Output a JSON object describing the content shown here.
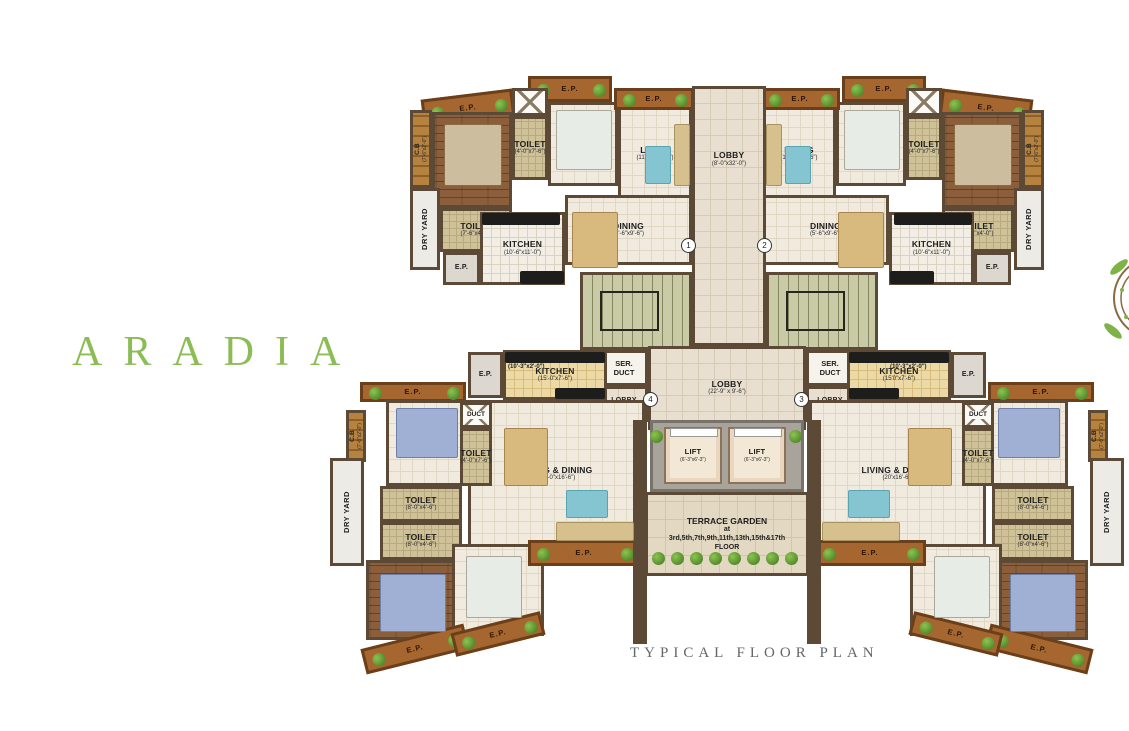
{
  "title": {
    "text": "ARADIA"
  },
  "caption": {
    "text": "TYPICAL FLOOR PLAN"
  },
  "colors": {
    "accent_green": "#8cbd55",
    "wall_brown": "#5c4a37",
    "caption_gray": "#63666b",
    "balcony_brown": "#a5672f"
  },
  "rooms": [
    {
      "id": "ep-balcony-tl-outer",
      "type": "ep",
      "name": "E.P.",
      "x": 528,
      "y": 76,
      "w": 84,
      "h": 26
    },
    {
      "id": "ep-balcony-tl-corner",
      "type": "ep",
      "name": "E.P.",
      "x": 422,
      "y": 94,
      "w": 92,
      "h": 28,
      "rot": -7
    },
    {
      "id": "cupboard-tl",
      "type": "cb",
      "vert": true,
      "name": "C.B",
      "dims": "(7'-6\"x2'-0\")",
      "x": 410,
      "y": 110,
      "w": 22,
      "h": 78
    },
    {
      "id": "bedroom2-tl",
      "type": "wood",
      "name": "BED 2",
      "dims": "(10'-0\"x12'-0\")",
      "x": 432,
      "y": 112,
      "w": 80,
      "h": 96
    },
    {
      "id": "duct-shaft-tl",
      "type": "ductx",
      "x": 512,
      "y": 88,
      "w": 36,
      "h": 28
    },
    {
      "id": "toilet1-tl",
      "type": "toilet",
      "name": "TOILET",
      "dims": "(4'-0\"x7'-6\")",
      "x": 512,
      "y": 116,
      "w": 36,
      "h": 64
    },
    {
      "id": "bedroom1-tl",
      "type": "cream",
      "name": "BED 1",
      "dims": "(9'-0\"x11'-0\")",
      "x": 548,
      "y": 102,
      "w": 70,
      "h": 84
    },
    {
      "id": "dryyard-tl",
      "type": "dry",
      "vert": true,
      "name": "DRY YARD",
      "x": 410,
      "y": 188,
      "w": 30,
      "h": 82
    },
    {
      "id": "toilet2-tl",
      "type": "toilet",
      "name": "TOILET",
      "dims": "(7'-6\"x4'-0\")",
      "x": 440,
      "y": 208,
      "w": 72,
      "h": 44
    },
    {
      "id": "kitchen-tl",
      "type": "ktile",
      "name": "KITCHEN",
      "dims": "(10'-6\"x11'-0\")",
      "x": 480,
      "y": 212,
      "w": 85,
      "h": 73
    },
    {
      "id": "ep-service-tl",
      "type": "epgray",
      "name": "E.P.",
      "x": 443,
      "y": 252,
      "w": 37,
      "h": 33
    },
    {
      "id": "living-tl",
      "type": "cream",
      "name": "LIVING",
      "dims": "(11'-0\"x20'-6\")",
      "x": 618,
      "y": 106,
      "w": 74,
      "h": 96
    },
    {
      "id": "dining-tl",
      "type": "cream",
      "name": "DINING",
      "dims": "(5'-6\"x9'-6\")",
      "x": 565,
      "y": 195,
      "w": 127,
      "h": 70
    },
    {
      "id": "ep-living-tl",
      "type": "ep",
      "name": "E.P.",
      "x": 614,
      "y": 88,
      "w": 80,
      "h": 22
    },
    {
      "id": "ep-balcony-tr-outer",
      "type": "ep",
      "name": "E.P.",
      "x": 842,
      "y": 76,
      "w": 84,
      "h": 26
    },
    {
      "id": "ep-balcony-tr-corner",
      "type": "ep",
      "name": "E.P.",
      "x": 940,
      "y": 94,
      "w": 92,
      "h": 28,
      "rot": 7
    },
    {
      "id": "cupboard-tr",
      "type": "cb",
      "vert": true,
      "name": "C.B",
      "dims": "(7'-6\"x2'-0\")",
      "x": 1022,
      "y": 110,
      "w": 22,
      "h": 78
    },
    {
      "id": "bedroom2-tr",
      "type": "wood",
      "name": "BED 2",
      "dims": "(10'-0\"x12'-0\")",
      "x": 942,
      "y": 112,
      "w": 80,
      "h": 96
    },
    {
      "id": "duct-shaft-tr",
      "type": "ductx",
      "x": 906,
      "y": 88,
      "w": 36,
      "h": 28
    },
    {
      "id": "toilet1-tr",
      "type": "toilet",
      "name": "TOILET",
      "dims": "(4'-0\"x7'-6\")",
      "x": 906,
      "y": 116,
      "w": 36,
      "h": 64
    },
    {
      "id": "bedroom1-tr",
      "type": "cream",
      "name": "BED 1",
      "dims": "(9'-0\"x11'-0\")",
      "x": 836,
      "y": 102,
      "w": 70,
      "h": 84
    },
    {
      "id": "dryyard-tr",
      "type": "dry",
      "vert": true,
      "name": "DRY YARD",
      "x": 1014,
      "y": 188,
      "w": 30,
      "h": 82
    },
    {
      "id": "toilet2-tr",
      "type": "toilet",
      "name": "TOILET",
      "dims": "(7'-6\"x4'-0\")",
      "x": 942,
      "y": 208,
      "w": 72,
      "h": 44
    },
    {
      "id": "kitchen-tr",
      "type": "ktile",
      "name": "KITCHEN",
      "dims": "(10'-6\"x11'-0\")",
      "x": 889,
      "y": 212,
      "w": 85,
      "h": 73
    },
    {
      "id": "ep-service-tr",
      "type": "epgray",
      "name": "E.P.",
      "x": 974,
      "y": 252,
      "w": 37,
      "h": 33
    },
    {
      "id": "living-tr",
      "type": "cream",
      "name": "LIVING",
      "dims": "(11'-0\"x20'-6\")",
      "x": 762,
      "y": 106,
      "w": 74,
      "h": 96
    },
    {
      "id": "dining-tr",
      "type": "cream",
      "name": "DINING",
      "dims": "(5'-6\"x9'-6\")",
      "x": 762,
      "y": 195,
      "w": 127,
      "h": 70
    },
    {
      "id": "ep-living-tr",
      "type": "ep",
      "name": "E.P.",
      "x": 760,
      "y": 88,
      "w": 80,
      "h": 22
    },
    {
      "id": "lobby-upper",
      "type": "lobby",
      "labelTop": true,
      "name": "LOBBY",
      "dims": "(8'-0\"x32'-0\")",
      "x": 692,
      "y": 86,
      "w": 74,
      "h": 260
    },
    {
      "id": "staircase-left",
      "type": "stairs",
      "x": 580,
      "y": 272,
      "w": 112,
      "h": 78
    },
    {
      "id": "staircase-right",
      "type": "stairs",
      "x": 766,
      "y": 272,
      "w": 112,
      "h": 78
    },
    {
      "id": "service-duct-left",
      "type": "white",
      "lines": [
        "SER.",
        "DUCT"
      ],
      "x": 600,
      "y": 350,
      "w": 48,
      "h": 36
    },
    {
      "id": "service-duct-right",
      "type": "white",
      "lines": [
        "SER.",
        "DUCT"
      ],
      "x": 806,
      "y": 350,
      "w": 48,
      "h": 36
    },
    {
      "id": "lobby-main",
      "type": "lobby",
      "name": "LOBBY",
      "dims": "(22'-9\" x 9'-6\")",
      "x": 648,
      "y": 346,
      "w": 158,
      "h": 84
    },
    {
      "id": "lobby-entry-left",
      "type": "lobby lobbysmall",
      "name": "LOBBY",
      "dims": "(5'-6\"x4'-6\")",
      "x": 600,
      "y": 386,
      "w": 48,
      "h": 36
    },
    {
      "id": "lobby-entry-right",
      "type": "lobby lobbysmall",
      "name": "LOBBY",
      "dims": "(5'-6\"x4'-6\")",
      "x": 806,
      "y": 386,
      "w": 48,
      "h": 36
    },
    {
      "id": "lift-shaft-frame",
      "type": "liftframe",
      "x": 650,
      "y": 420,
      "w": 154,
      "h": 72
    },
    {
      "id": "lift-1",
      "type": "lift",
      "name": "LIFT",
      "dims": "(6'-3\"x6'-3\")",
      "x": 664,
      "y": 427,
      "w": 58,
      "h": 57
    },
    {
      "id": "lift-2",
      "type": "lift",
      "name": "LIFT",
      "dims": "(6'-3\"x6'-3\")",
      "x": 728,
      "y": 427,
      "w": 58,
      "h": 57
    },
    {
      "id": "terrace-garden",
      "type": "terrace",
      "lines": [
        "TERRACE GARDEN",
        "at",
        "3rd,5th,7th,9th,11th,13th,15th&17th",
        "FLOOR"
      ],
      "x": 645,
      "y": 492,
      "w": 164,
      "h": 84
    },
    {
      "id": "post-left",
      "type": "wallbox",
      "x": 633,
      "y": 420,
      "w": 14,
      "h": 224
    },
    {
      "id": "post-right",
      "type": "wallbox",
      "x": 807,
      "y": 420,
      "w": 14,
      "h": 224
    },
    {
      "id": "kitchen-bl",
      "type": "ktan",
      "name": "KITCHEN",
      "dims": "(15'-0\"x7'-6\")",
      "x": 503,
      "y": 350,
      "w": 104,
      "h": 50
    },
    {
      "id": "ep-service-bl",
      "type": "epgray",
      "name": "E.P.",
      "x": 468,
      "y": 352,
      "w": 35,
      "h": 46
    },
    {
      "id": "living-dining-bl",
      "type": "cream",
      "name": "LIVING & DINING",
      "dims": "(20'-0\"x16'-6\")",
      "x": 468,
      "y": 400,
      "w": 177,
      "h": 148
    },
    {
      "id": "ep-balcony-bl-top",
      "type": "ep",
      "name": "E.P.",
      "x": 360,
      "y": 382,
      "w": 106,
      "h": 20
    },
    {
      "id": "bedroom3-bl",
      "type": "cream",
      "name": "BED 3",
      "dims": "(12'-0\"x10'-6\")",
      "x": 386,
      "y": 400,
      "w": 82,
      "h": 86
    },
    {
      "id": "duct-bl",
      "type": "ductx",
      "lines": [
        "DUCT"
      ],
      "x": 460,
      "y": 402,
      "w": 32,
      "h": 26
    },
    {
      "id": "toilet-small-bl",
      "type": "toilet",
      "name": "TOILET",
      "dims": "(4'-0\"x7'-6\")",
      "x": 460,
      "y": 428,
      "w": 32,
      "h": 58
    },
    {
      "id": "cupboard-bl",
      "type": "cb",
      "vert": true,
      "name": "C.B",
      "dims": "(7'-6\"x2'-0\")",
      "x": 346,
      "y": 410,
      "w": 20,
      "h": 52
    },
    {
      "id": "toilet-a-bl",
      "type": "toilet",
      "name": "TOILET",
      "dims": "(8'-0\"x4'-6\")",
      "x": 380,
      "y": 486,
      "w": 82,
      "h": 36
    },
    {
      "id": "toilet-b-bl",
      "type": "toilet",
      "name": "TOILET",
      "dims": "(8'-0\"x4'-6\")",
      "x": 380,
      "y": 522,
      "w": 82,
      "h": 38
    },
    {
      "id": "dryyard-bl",
      "type": "dry",
      "vert": true,
      "name": "DRY YARD",
      "x": 330,
      "y": 458,
      "w": 34,
      "h": 108
    },
    {
      "id": "bedroom2-bl",
      "type": "wood",
      "name": "BED 2",
      "dims": "(12'-0\"x10'-6\")",
      "x": 366,
      "y": 560,
      "w": 102,
      "h": 80
    },
    {
      "id": "bedroom1-bl",
      "type": "cream",
      "name": "BED 1",
      "dims": "(9'x10'-6\")",
      "x": 452,
      "y": 544,
      "w": 92,
      "h": 92
    },
    {
      "id": "ep-balcony-bl-b1",
      "type": "ep",
      "name": "E.P.",
      "x": 362,
      "y": 636,
      "w": 106,
      "h": 26,
      "rot": -14
    },
    {
      "id": "ep-balcony-bl-b2",
      "type": "ep",
      "name": "E.P.",
      "x": 452,
      "y": 622,
      "w": 92,
      "h": 24,
      "rot": -14
    },
    {
      "id": "ep-balcony-bl-right",
      "type": "ep",
      "name": "E.P.",
      "x": 528,
      "y": 540,
      "w": 112,
      "h": 26
    },
    {
      "id": "kitchen-br",
      "type": "ktan",
      "name": "KITCHEN",
      "dims": "(15'0\"x7'-6\")",
      "x": 847,
      "y": 350,
      "w": 104,
      "h": 50
    },
    {
      "id": "ep-service-br",
      "type": "epgray",
      "name": "E.P.",
      "x": 951,
      "y": 352,
      "w": 35,
      "h": 46
    },
    {
      "id": "living-dining-br",
      "type": "cream",
      "name": "LIVING & DINING",
      "dims": "(20'x16'-6\")",
      "x": 809,
      "y": 400,
      "w": 177,
      "h": 148
    },
    {
      "id": "ep-balcony-br-top",
      "type": "ep",
      "name": "E.P.",
      "x": 988,
      "y": 382,
      "w": 106,
      "h": 20
    },
    {
      "id": "bedroom3-br",
      "type": "cream",
      "name": "BED 3",
      "dims": "(12'-0\"x10'-6\")",
      "x": 986,
      "y": 400,
      "w": 82,
      "h": 86
    },
    {
      "id": "duct-br",
      "type": "ductx",
      "lines": [
        "DUCT"
      ],
      "x": 962,
      "y": 402,
      "w": 32,
      "h": 26
    },
    {
      "id": "toilet-small-br",
      "type": "toilet",
      "name": "TOILET",
      "dims": "(4'-0\"x7'-6\")",
      "x": 962,
      "y": 428,
      "w": 32,
      "h": 58
    },
    {
      "id": "cupboard-br",
      "type": "cb",
      "vert": true,
      "name": "C.B",
      "dims": "(7'-6\"x2'-0\")",
      "x": 1088,
      "y": 410,
      "w": 20,
      "h": 52
    },
    {
      "id": "toilet-a-br",
      "type": "toilet",
      "name": "TOILET",
      "dims": "(8'-0\"x4'-6\")",
      "x": 992,
      "y": 486,
      "w": 82,
      "h": 36
    },
    {
      "id": "toilet-b-br",
      "type": "toilet",
      "name": "TOILET",
      "dims": "(8'-0\"x4'-6\")",
      "x": 992,
      "y": 522,
      "w": 82,
      "h": 38
    },
    {
      "id": "dryyard-br",
      "type": "dry",
      "vert": true,
      "name": "DRY YARD",
      "x": 1090,
      "y": 458,
      "w": 34,
      "h": 108
    },
    {
      "id": "bedroom2-br",
      "type": "wood",
      "name": "BED 2",
      "dims": "(12'-0\"x10'-6\")",
      "x": 986,
      "y": 560,
      "w": 102,
      "h": 80
    },
    {
      "id": "bedroom1-br",
      "type": "cream",
      "name": "BED 1",
      "dims": "(9'-0\"x10'-6\")",
      "x": 910,
      "y": 544,
      "w": 92,
      "h": 92
    },
    {
      "id": "ep-balcony-br-b1",
      "type": "ep",
      "name": "E.P.",
      "x": 986,
      "y": 636,
      "w": 106,
      "h": 26,
      "rot": 14
    },
    {
      "id": "ep-balcony-br-b2",
      "type": "ep",
      "name": "E.P.",
      "x": 910,
      "y": 622,
      "w": 92,
      "h": 24,
      "rot": 14
    },
    {
      "id": "ep-balcony-br-right",
      "type": "ep",
      "name": "E.P.",
      "x": 814,
      "y": 540,
      "w": 112,
      "h": 26
    }
  ],
  "door_markers": [
    {
      "num": "1",
      "x": 681,
      "y": 238
    },
    {
      "num": "2",
      "x": 757,
      "y": 238
    },
    {
      "num": "3",
      "x": 794,
      "y": 392
    },
    {
      "num": "4",
      "x": 643,
      "y": 392
    }
  ],
  "extra_labels": [
    {
      "text": "(10'-3\"x2'-0\")",
      "x": 508,
      "y": 364
    },
    {
      "text": "(10'-3\"x2'-0\")",
      "x": 890,
      "y": 364
    }
  ]
}
